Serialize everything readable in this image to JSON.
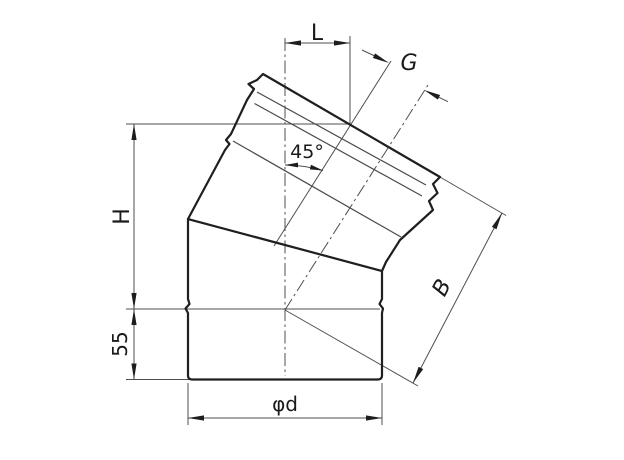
{
  "drawing": {
    "kind": "technical-drawing-45-degree-pipe-elbow",
    "angle_label": "45°",
    "bottom_stub_length": "55",
    "dimension_names": [
      "L",
      "G",
      "H",
      "55",
      "B",
      "φd",
      "45°"
    ]
  },
  "colors": {
    "background": "#ffffff",
    "outline": "#1f1f1f",
    "seam": "#4a4a4a",
    "thin": "#4f4f4f",
    "arrow_fill": "#1d1d1d",
    "text": "#1a1a1a"
  },
  "labels": [
    {
      "id": "dim-label-L",
      "text": "L",
      "x": 317,
      "y": 40,
      "size": 22,
      "rot": 0,
      "italic": false
    },
    {
      "id": "dim-label-G",
      "text": "G",
      "x": 409,
      "y": 70,
      "size": 22,
      "rot": 0,
      "italic": true
    },
    {
      "id": "angle-label-45",
      "text": "45°",
      "x": 307,
      "y": 158,
      "size": 19,
      "rot": 0,
      "italic": false
    },
    {
      "id": "dim-label-H",
      "text": "H",
      "x": 129,
      "y": 216.5,
      "size": 22,
      "rot": -90,
      "italic": false
    },
    {
      "id": "dim-label-55",
      "text": "55",
      "x": 127,
      "y": 344,
      "size": 20,
      "rot": -90,
      "italic": false
    },
    {
      "id": "dim-label-B",
      "text": "B",
      "x": 448,
      "y": 291,
      "size": 22,
      "rot": -62,
      "italic": true
    },
    {
      "id": "dim-label-diameter",
      "text": "φd",
      "x": 285,
      "y": 411,
      "size": 20,
      "rot": 0,
      "italic": false
    }
  ],
  "outline_paths": [
    "M 263,74 L 440,177 L 433,184 L 437.5,193 L 429,201 L 433,210 L 400,240 L 386,262 L 382,271 L 382,299 L 379.5,304 L 383,308.5 L 382,313 L 382,375.5 Q 382,379.5 377.5,379.5 L 192.5,379.5 Q 188,379.5 188,375.5 L 188,313 L 185.5,308.5 L 189.5,304 L 188,299 L 188,219 L 225,150 L 229.5,144 L 226,140 L 231,134 L 247,100 L 254,89 L 248.5,84 L 257,80 Z",
    "M 188,219 L 382,271"
  ],
  "seam_lines": [
    {
      "x1": 257,
      "y1": 92,
      "x2": 426,
      "y2": 185
    },
    {
      "x1": 254.5,
      "y1": 103.5,
      "x2": 422,
      "y2": 196
    },
    {
      "x1": 233,
      "y1": 141,
      "x2": 401,
      "y2": 237
    }
  ],
  "thin_segments": [
    {
      "x1": 126,
      "y1": 124,
      "x2": 350,
      "y2": 124
    },
    {
      "x1": 126,
      "y1": 309,
      "x2": 380,
      "y2": 309
    },
    {
      "x1": 126,
      "y1": 379.5,
      "x2": 190,
      "y2": 379.5
    },
    {
      "x1": 134,
      "y1": 124,
      "x2": 134,
      "y2": 379.5
    },
    {
      "x1": 285,
      "y1": 43,
      "x2": 350,
      "y2": 43
    },
    {
      "x1": 350,
      "y1": 36,
      "x2": 350,
      "y2": 124
    },
    {
      "x1": 188,
      "y1": 418,
      "x2": 382,
      "y2": 418
    },
    {
      "x1": 188,
      "y1": 383,
      "x2": 188,
      "y2": 425
    },
    {
      "x1": 382,
      "y1": 383,
      "x2": 382,
      "y2": 425
    },
    {
      "x1": 502,
      "y1": 213,
      "x2": 413,
      "y2": 383
    },
    {
      "x1": 440,
      "y1": 177,
      "x2": 506,
      "y2": 215.5
    },
    {
      "x1": 285,
      "y1": 310,
      "x2": 418,
      "y2": 386
    },
    {
      "x1": 362,
      "y1": 50,
      "x2": 377,
      "y2": 57
    },
    {
      "x1": 439,
      "y1": 97.3,
      "x2": 448,
      "y2": 101.7
    },
    {
      "x1": 274,
      "y1": 246,
      "x2": 391,
      "y2": 61
    }
  ],
  "dashdot_segments": [
    {
      "x1": 285,
      "y1": 38,
      "x2": 285,
      "y2": 376
    },
    {
      "x1": 285,
      "y1": 310,
      "x2": 428,
      "y2": 85
    }
  ],
  "arcs": [
    {
      "d": "M 285,165 A 145,145 0 0 1 323,170.5"
    }
  ],
  "arrows": [
    {
      "name": "arrow-L-left",
      "points": "285,43 301,40.4 301,45.6"
    },
    {
      "name": "arrow-L-right",
      "points": "350,43 334,40.4 334,45.6"
    },
    {
      "name": "arrow-H-top",
      "points": "134,124 131.4,140 136.6,140"
    },
    {
      "name": "arrow-H-bottom",
      "points": "134,309 131.4,293 136.6,293"
    },
    {
      "name": "arrow-55-top",
      "points": "134,309 131.4,325 136.6,325"
    },
    {
      "name": "arrow-55-bottom",
      "points": "134,379.5 131.4,363.5 136.6,363.5"
    },
    {
      "name": "arrow-diameter-left",
      "points": "188,418 204,415.4 204,420.6"
    },
    {
      "name": "arrow-diameter-right",
      "points": "382,418 366,415.4 366,420.6"
    },
    {
      "name": "arrow-B-upper",
      "points": "502,213 496.5,229.3 491.9,226.9"
    },
    {
      "name": "arrow-B-lower",
      "points": "413,383 423.2,369.1 418.6,366.7"
    },
    {
      "name": "arrow-G-left",
      "points": "389,63 372.9,58 375.1,53.4"
    },
    {
      "name": "arrow-G-right",
      "points": "424,90 437.9,99.6 440.1,95"
    },
    {
      "name": "arrow-angle-left",
      "points": "285,165 298,162.6 298,167.4"
    },
    {
      "name": "arrow-angle-right",
      "points": "323,170.5 309.8,169.4 311,164.8"
    }
  ]
}
